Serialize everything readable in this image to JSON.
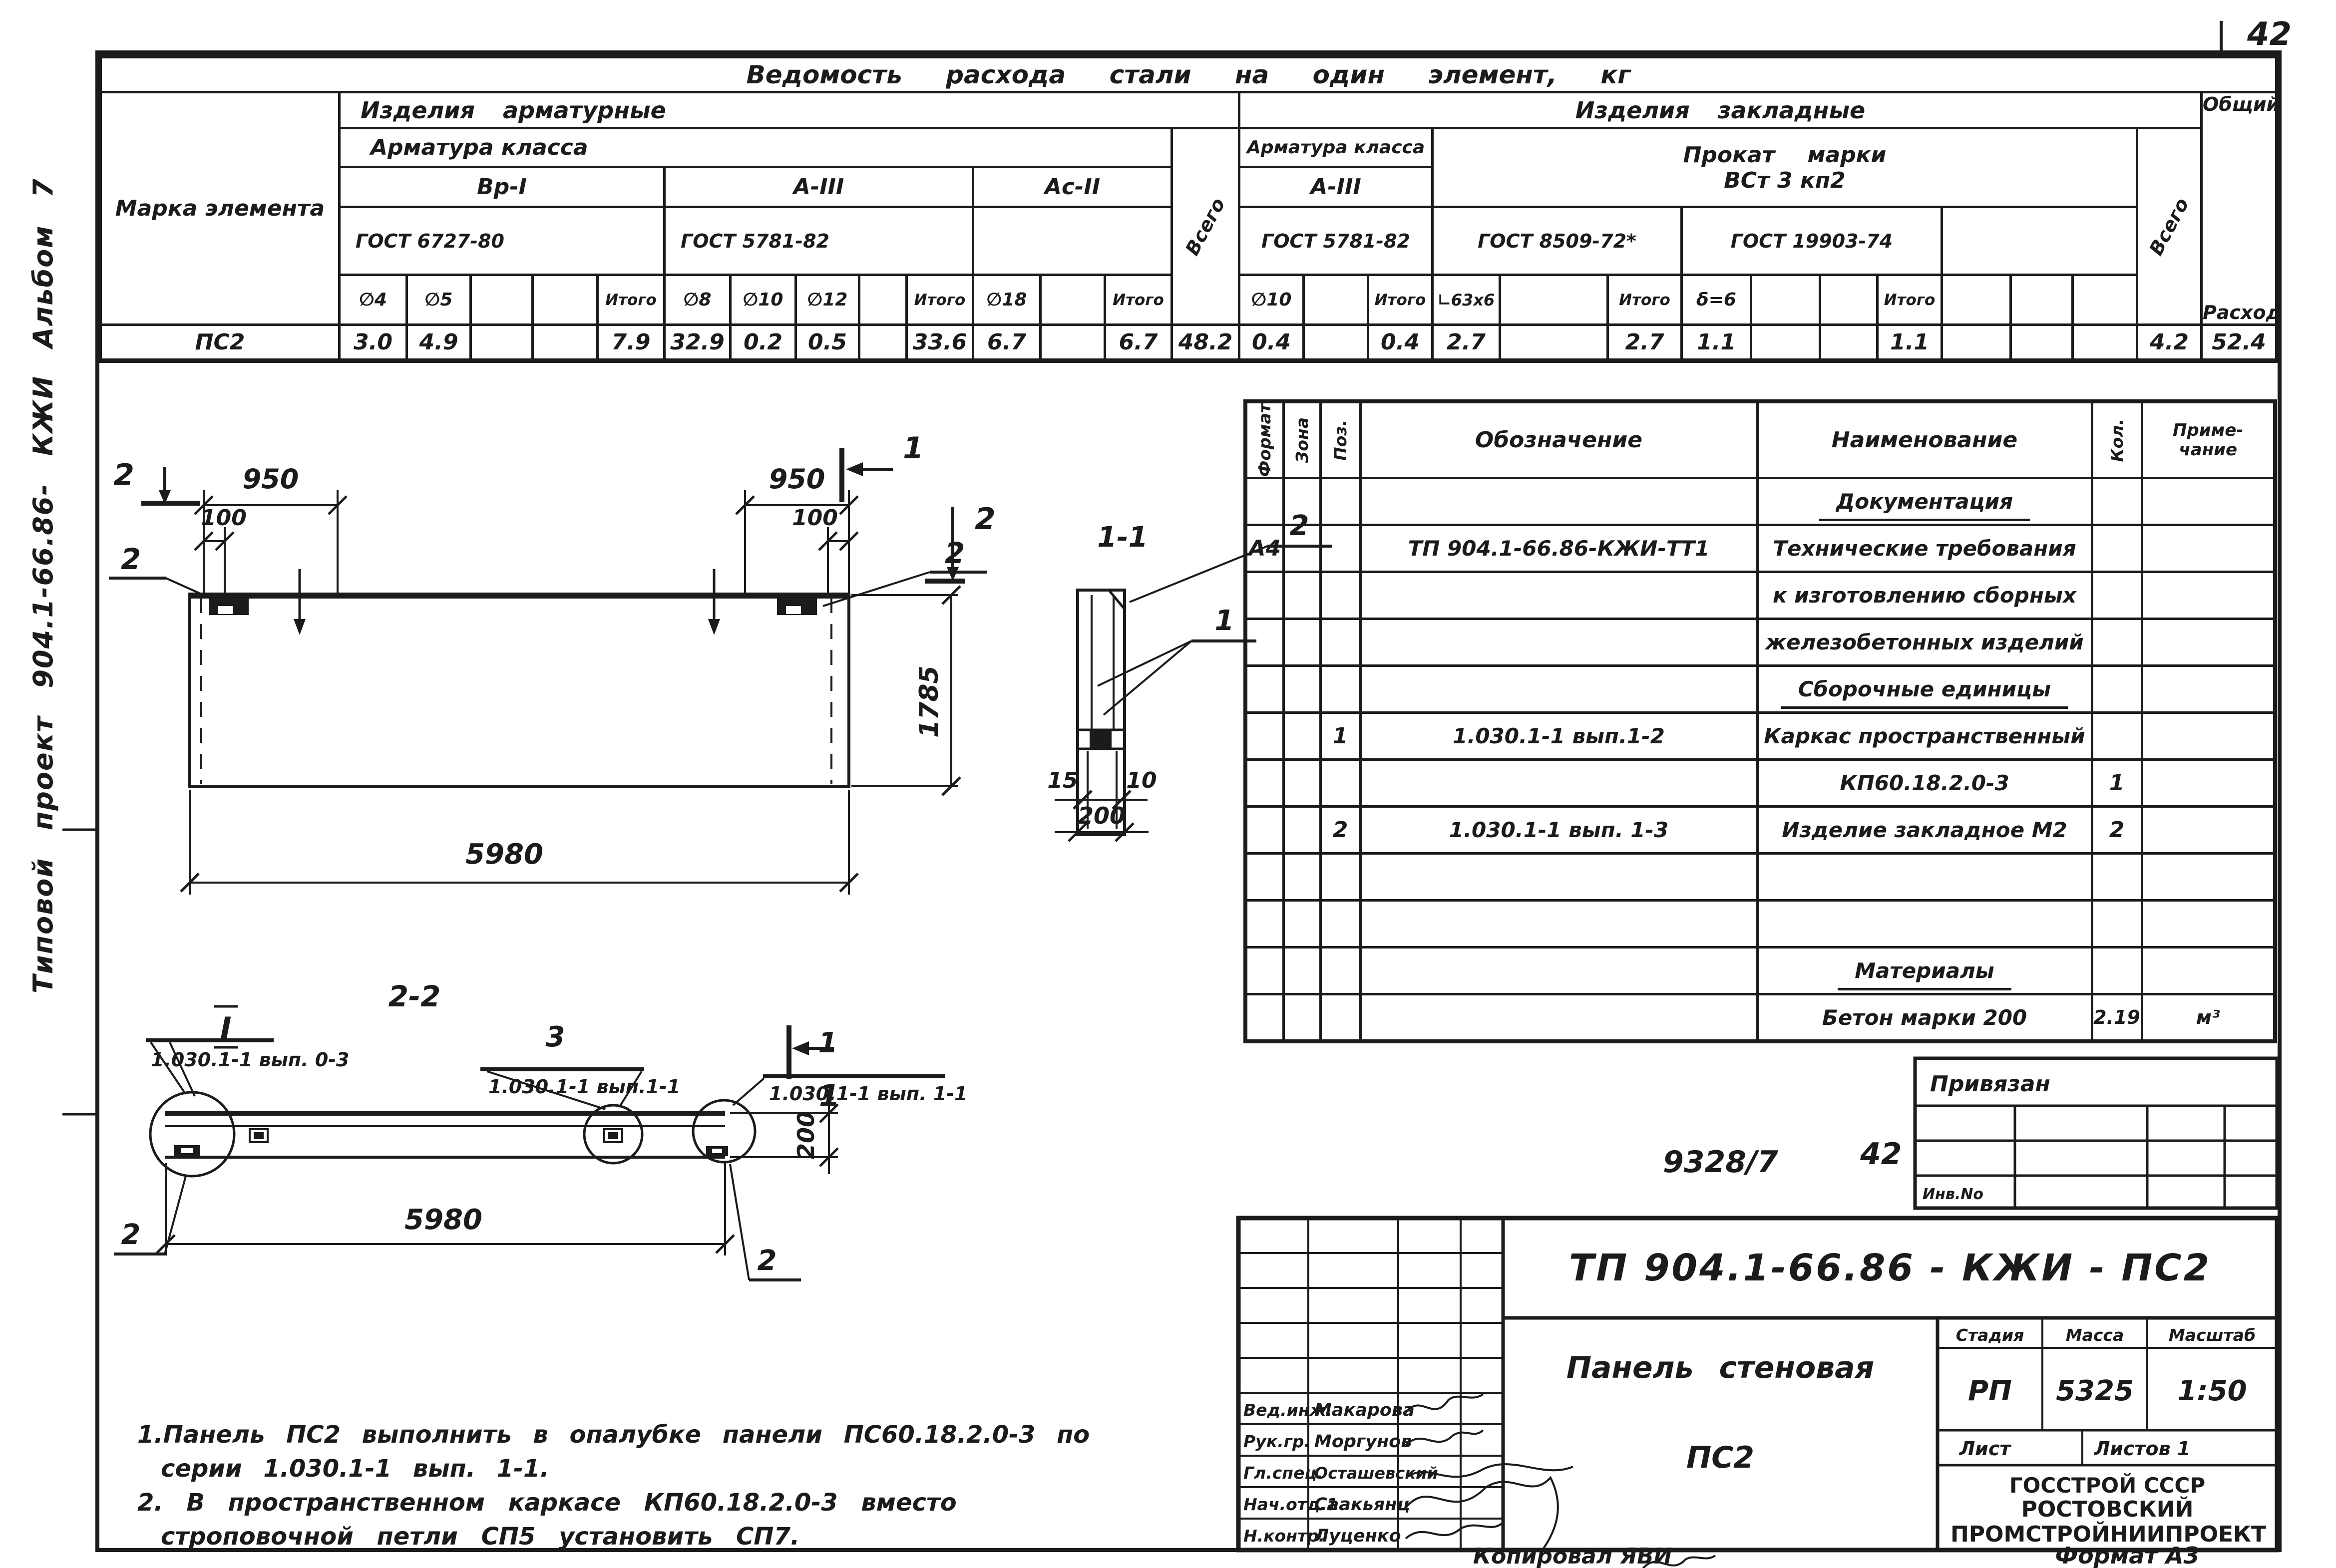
{
  "sheet": {
    "corner_number": "42",
    "side_text": "Типовой  проект   904.1-66.86- КЖИ  Альбом 7",
    "doc_ref": "9328/7",
    "sheet_ref": "42",
    "inventory_label": "Инв.No",
    "binding_label": "Привязан",
    "copied_label": "Копировал ЯВИ",
    "format_label": "Формат А3"
  },
  "steel_table": {
    "title": "Ведомость расхода стали на один элемент, кг",
    "mark_header": "Марка элемента",
    "group_reinforcement": "Изделия арматурные",
    "group_embedded": "Изделия закладные",
    "class_header_1": "Арматура класса",
    "class_header_2": "Арматура класса",
    "vsego_1": "Всего",
    "vsego_2": "Всего",
    "total_1": "Общий",
    "total_2": "Расход",
    "class_vr1": "Вр-I",
    "class_a3": "А-III",
    "class_ac2": "Ас-II",
    "class_a3_emb": "А-III",
    "gost_6727": "ГОСТ 6727-80",
    "gost_5781": "ГОСТ 5781-82",
    "gost_5781_emb": "ГОСТ 5781-82",
    "gost_8509": "ГОСТ 8509-72*",
    "gost_19903": "ГОСТ 19903-74",
    "prokat_1": "Прокат марки",
    "prokat_2": "ВСт 3 кп2",
    "itogo": "Итого",
    "dia_4": "∅4",
    "dia_5": "∅5",
    "dia_8": "∅8",
    "dia_10": "∅10",
    "dia_12": "∅12",
    "dia_18": "∅18",
    "dia_10_emb": "∅10",
    "angle_63": "∟63x6",
    "sheet_6": "δ=6",
    "row_mark": "ПС2",
    "values": [
      "3.0",
      "4.9",
      "",
      "",
      "7.9",
      "32.9",
      "0.2",
      "0.5",
      "",
      "33.6",
      "6.7",
      "",
      "6.7",
      "48.2",
      "0.4",
      "",
      "0.4",
      "2.7",
      "",
      "2.7",
      "1.1",
      "",
      "",
      "1.1",
      "",
      "",
      "",
      "4.2",
      "52.4"
    ]
  },
  "spec_table": {
    "h_format": "Формат",
    "h_zone": "Зона",
    "h_pos": "Поз.",
    "h_designation": "Обозначение",
    "h_name": "Наименование",
    "h_qty": "Кол.",
    "h_note_1": "Приме-",
    "h_note_2": "чание",
    "rows": [
      {
        "name": "Документация"
      },
      {
        "format": "А4",
        "designation": "ТП 904.1-66.86-КЖИ-ТТ1",
        "name": "Технические требования"
      },
      {
        "name": "к изготовлению сборных"
      },
      {
        "name": "железобетонных изделий"
      },
      {
        "name": "Сборочные единицы"
      },
      {
        "pos": "1",
        "designation": "1.030.1-1 вып.1-2",
        "name": "Каркас пространственный"
      },
      {
        "name": "КП60.18.2.0-3",
        "qty": "1"
      },
      {
        "pos": "2",
        "designation": "1.030.1-1 вып. 1-3",
        "name": "Изделие закладное М2",
        "qty": "2"
      },
      {},
      {},
      {
        "name": "Материалы"
      },
      {
        "name": "Бетон марки 200",
        "qty": "2.19",
        "note": "м³"
      }
    ]
  },
  "title_block": {
    "doc_number": "ТП 904.1-66.86 - КЖИ - ПС2",
    "product_1": "Панель стеновая",
    "product_2": "ПС2",
    "stage_label": "Стадия",
    "mass_label": "Масса",
    "scale_label": "Масштаб",
    "stage": "РП",
    "mass": "5325",
    "scale": "1:50",
    "sheet_label": "Лист",
    "sheets_label": "Листов 1",
    "org_1": "ГОССТРОЙ СССР",
    "org_2": "РОСТОВСКИЙ",
    "org_3": "ПРОМСТРОЙНИИПРОЕКТ",
    "sig_1_role": "Вед.инж.",
    "sig_1_name": "Макарова",
    "sig_2_role": "Рук.гр.",
    "sig_2_name": "Моргунов",
    "sig_3_role": "Гл.спец.",
    "sig_3_name": "Осташевский",
    "sig_4_role": "Нач.отд.1",
    "sig_4_name": "Саакьянц",
    "sig_5_role": "Н.контр.",
    "sig_5_name": "Луценко"
  },
  "notes": {
    "line1": "1.Панель ПС2 выполнить в опалубке панели ПС60.18.2.0-3 по",
    "line2": "серии 1.030.1-1 вып. 1-1.",
    "line3": "2. В пространственном каркасе КП60.18.2.0-3 вместо",
    "line4": "строповочной петли СП5 установить СП7."
  },
  "drawing": {
    "plan": {
      "cut2_top_left": "2",
      "cut2_top_right": "2",
      "cut1_top": "1",
      "cut1_bottom": "1",
      "callout_left": "2",
      "callout_right": "2",
      "dim_950_left": "950",
      "dim_100_left": "100",
      "dim_950_right": "950",
      "dim_100_right": "100",
      "dim_height": "1785",
      "dim_length": "5980"
    },
    "section11": {
      "label": "1-1",
      "callout1": "1",
      "callout2": "2",
      "dim15": "15",
      "dim10": "10",
      "dim200": "200"
    },
    "section22": {
      "label": "2-2",
      "roman": "I",
      "flag_left": "1.030.1-1 вып. 0-3",
      "flag_mid_num": "3",
      "flag_mid": "1.030.1-1 вып.1-1",
      "flag_right_num": "1",
      "flag_right": "1.030.1-1 вып. 1-1",
      "callout_bl": "2",
      "callout_br": "2",
      "dim200": "200",
      "dim_length": "5980"
    }
  }
}
